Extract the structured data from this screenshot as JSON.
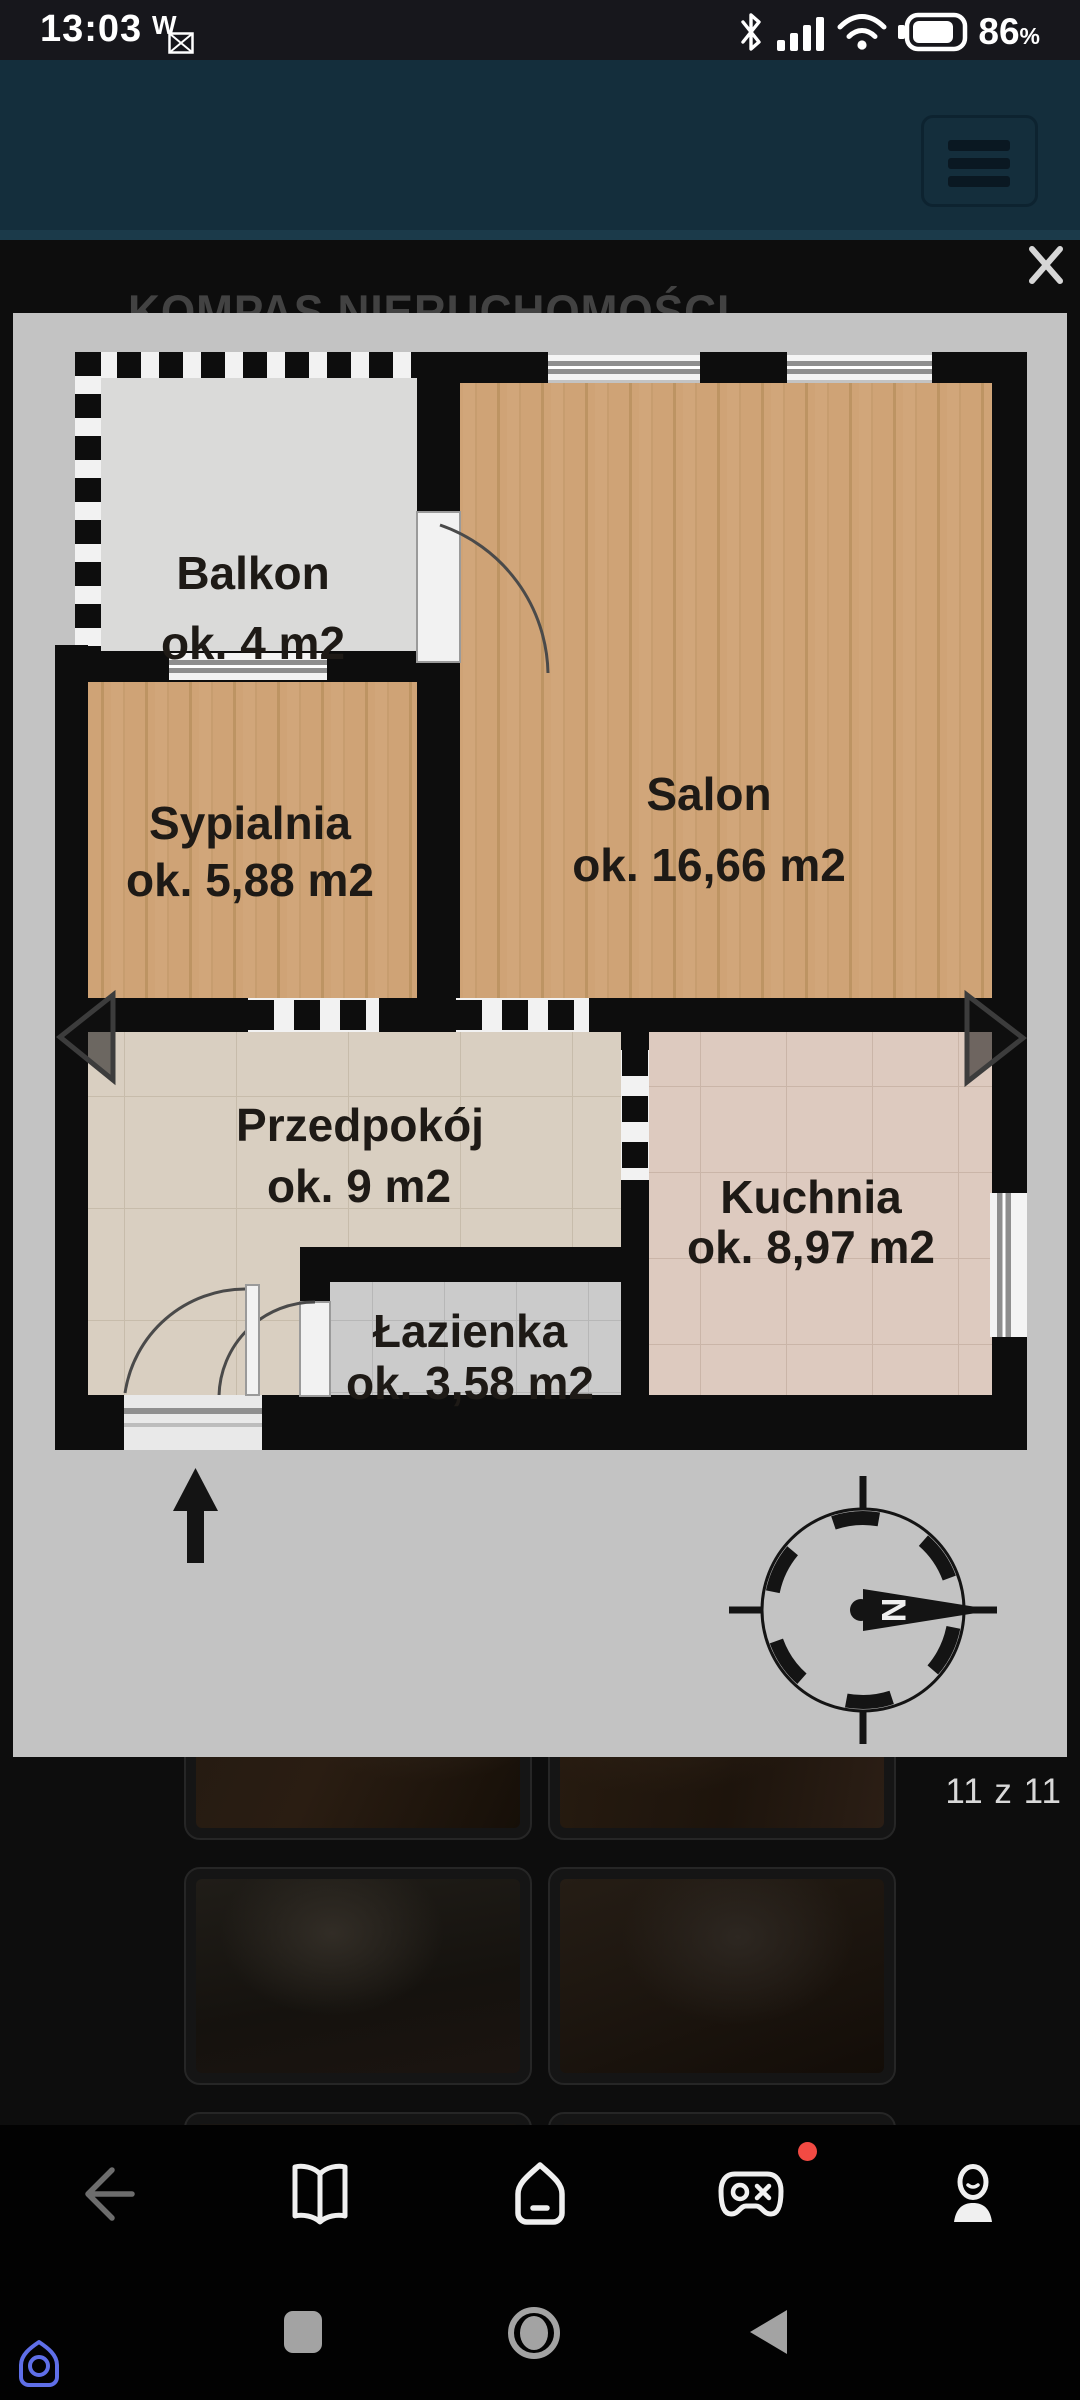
{
  "status_bar": {
    "time": "13:03",
    "vowifi_label": "W",
    "battery_percent": "86",
    "percent_sign": "%",
    "icons": [
      "vowifi-message-icon",
      "bluetooth-icon",
      "signal-icon",
      "wifi-icon",
      "battery-icon"
    ]
  },
  "header": {
    "menu_icon": "hamburger-icon",
    "background_color": "#142e3c"
  },
  "page": {
    "brand": "KOMPAS NIERUCHOMOŚCI"
  },
  "lightbox": {
    "close_icon": "close-icon",
    "counter": "11 z 11"
  },
  "floor_plan": {
    "rooms": {
      "balkon": {
        "name": "Balkon",
        "area": "ok. 4 m2"
      },
      "salon": {
        "name": "Salon",
        "area": "ok. 16,66 m2"
      },
      "sypialnia": {
        "name": "Sypialnia",
        "area": "ok. 5,88 m2"
      },
      "przedpokoj": {
        "name": "Przedpokój",
        "area": "ok. 9 m2"
      },
      "kuchnia": {
        "name": "Kuchnia",
        "area": "ok. 8,97 m2"
      },
      "lazienka": {
        "name": "Łazienka",
        "area": "ok. 3,58 m2"
      }
    },
    "compass_north_letter": "N",
    "nav_icons": [
      "prev-photo-arrow",
      "next-photo-arrow"
    ],
    "entrance_marker": "entrance-arrow-icon"
  },
  "bottom_nav": {
    "icons": [
      "back-arrow-icon",
      "book-icon",
      "home-icon",
      "game-controller-icon",
      "person-icon"
    ],
    "notification_dot_color": "#f24a43"
  },
  "android_nav": {
    "icons": [
      "recents-square-icon",
      "home-circle-icon",
      "back-triangle-icon",
      "app-logo-icon"
    ],
    "logo_color": "#5f6fe8"
  },
  "colors": {
    "header_teal": "#142e3c",
    "plan_background": "#c3c3c3",
    "wood_floor": "#cfa376",
    "notification_red": "#f24a43"
  }
}
